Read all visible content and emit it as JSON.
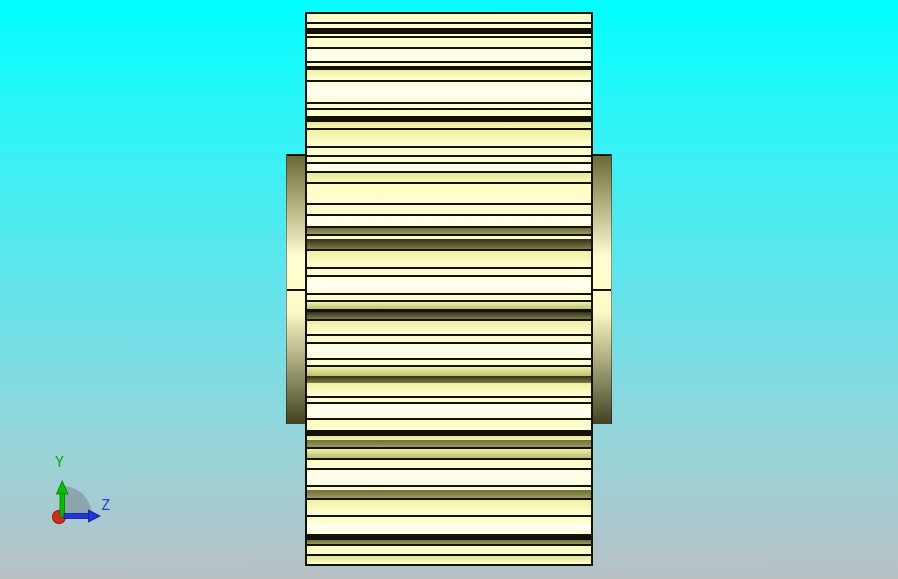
{
  "background": {
    "stops": [
      [
        "0%",
        "#00ffff"
      ],
      [
        "20%",
        "#2df5f7"
      ],
      [
        "50%",
        "#63e3ea"
      ],
      [
        "76%",
        "#95d5da"
      ],
      [
        "100%",
        "#b8c0c4"
      ]
    ]
  },
  "model": {
    "outline_color": "#13130a",
    "gear": {
      "x": 305,
      "y": 12,
      "w": 288,
      "h": 554
    },
    "hub": {
      "left_x": 286,
      "right_x": 593,
      "rim_w": 19,
      "top": 154,
      "bottom": 424,
      "seam_y": 289,
      "grad_top": "#6a6a38",
      "grad_light": "#ffffd2",
      "grad_mid": "#fbfbc6",
      "grad_bottom": "#424222"
    },
    "palette": {
      "k": "#12120a",
      "p": [
        "#fdfdc2",
        "#ffffd2"
      ],
      "w": [
        "#ffffd8",
        "#fffff4",
        "#ffffd8"
      ],
      "y": [
        "#e6e694",
        "#f6f6b0"
      ],
      "yd": [
        "#f2f2a2",
        "#bcbc74"
      ],
      "o": [
        "#6f6f3a",
        "#9a9a58"
      ],
      "d": [
        "#30301a",
        "#7d7d45"
      ],
      "g": [
        "#f0f09c",
        "#ffffd8"
      ]
    },
    "stripes": [
      [
        12,
        2,
        "k"
      ],
      [
        14,
        8,
        "p"
      ],
      [
        22,
        2,
        "k"
      ],
      [
        24,
        4,
        "p"
      ],
      [
        28,
        6,
        "k"
      ],
      [
        34,
        2,
        "p"
      ],
      [
        36,
        2,
        "k"
      ],
      [
        38,
        9,
        "p"
      ],
      [
        47,
        2,
        "k"
      ],
      [
        49,
        12,
        "w"
      ],
      [
        61,
        2,
        "k"
      ],
      [
        63,
        3,
        "p"
      ],
      [
        66,
        4,
        "k"
      ],
      [
        70,
        10,
        "g"
      ],
      [
        80,
        2,
        "k"
      ],
      [
        82,
        20,
        "w"
      ],
      [
        102,
        2,
        "k"
      ],
      [
        104,
        4,
        "p"
      ],
      [
        108,
        2,
        "k"
      ],
      [
        110,
        6,
        "p"
      ],
      [
        116,
        6,
        "k"
      ],
      [
        122,
        6,
        "y"
      ],
      [
        128,
        2,
        "k"
      ],
      [
        130,
        16,
        "g"
      ],
      [
        146,
        2,
        "k"
      ],
      [
        148,
        7,
        "p"
      ],
      [
        155,
        2,
        "k"
      ],
      [
        157,
        5,
        "p"
      ],
      [
        162,
        2,
        "k"
      ],
      [
        164,
        7,
        "w"
      ],
      [
        171,
        2,
        "k"
      ],
      [
        173,
        9,
        "y"
      ],
      [
        182,
        2,
        "k"
      ],
      [
        184,
        19,
        "p"
      ],
      [
        203,
        2,
        "k"
      ],
      [
        205,
        9,
        "p"
      ],
      [
        214,
        2,
        "k"
      ],
      [
        216,
        10,
        "w"
      ],
      [
        226,
        2,
        "k"
      ],
      [
        228,
        6,
        "o"
      ],
      [
        234,
        2,
        "k"
      ],
      [
        236,
        3,
        "p"
      ],
      [
        239,
        10,
        "d"
      ],
      [
        249,
        2,
        "k"
      ],
      [
        251,
        16,
        "g"
      ],
      [
        267,
        2,
        "k"
      ],
      [
        269,
        6,
        "p"
      ],
      [
        275,
        2,
        "k"
      ],
      [
        277,
        16,
        "w"
      ],
      [
        293,
        2,
        "k"
      ],
      [
        295,
        5,
        "p"
      ],
      [
        300,
        2,
        "k"
      ],
      [
        302,
        7,
        "yd"
      ],
      [
        309,
        3,
        "k"
      ],
      [
        312,
        7,
        "d"
      ],
      [
        319,
        2,
        "k"
      ],
      [
        321,
        13,
        "g"
      ],
      [
        334,
        2,
        "k"
      ],
      [
        336,
        6,
        "p"
      ],
      [
        342,
        2,
        "k"
      ],
      [
        344,
        14,
        "w"
      ],
      [
        358,
        2,
        "k"
      ],
      [
        360,
        5,
        "p"
      ],
      [
        365,
        2,
        "k"
      ],
      [
        367,
        9,
        "yd"
      ],
      [
        376,
        7,
        "d"
      ],
      [
        383,
        13,
        "g"
      ],
      [
        396,
        2,
        "k"
      ],
      [
        398,
        4,
        "p"
      ],
      [
        402,
        2,
        "k"
      ],
      [
        404,
        14,
        "w"
      ],
      [
        418,
        2,
        "k"
      ],
      [
        420,
        10,
        "p"
      ],
      [
        430,
        6,
        "k"
      ],
      [
        436,
        4,
        "y"
      ],
      [
        440,
        7,
        "o"
      ],
      [
        447,
        2,
        "k"
      ],
      [
        449,
        9,
        "yd"
      ],
      [
        458,
        2,
        "k"
      ],
      [
        460,
        8,
        "p"
      ],
      [
        468,
        2,
        "k"
      ],
      [
        470,
        15,
        "w"
      ],
      [
        485,
        2,
        "k"
      ],
      [
        487,
        3,
        "p"
      ],
      [
        490,
        8,
        "o"
      ],
      [
        498,
        2,
        "k"
      ],
      [
        500,
        15,
        "g"
      ],
      [
        515,
        2,
        "k"
      ],
      [
        517,
        5,
        "p"
      ],
      [
        522,
        12,
        "w"
      ],
      [
        534,
        6,
        "k"
      ],
      [
        540,
        4,
        "o"
      ],
      [
        544,
        2,
        "k"
      ],
      [
        546,
        8,
        "p"
      ],
      [
        554,
        2,
        "k"
      ],
      [
        556,
        6,
        "y"
      ],
      [
        562,
        2,
        "p"
      ],
      [
        564,
        2,
        "k"
      ]
    ]
  },
  "triad": {
    "labels": {
      "y": "Y",
      "z": "Z"
    },
    "colors": {
      "y_axis": "#00c300",
      "y_axis_dark": "#007d00",
      "z_axis": "#1c35e6",
      "z_axis_dark": "#101e8c",
      "x_origin": "#d82a18",
      "x_origin_dark": "#8e1a0e",
      "fan": "#76868f",
      "y_label": "#00b400",
      "z_label": "#2a3fd4"
    }
  }
}
